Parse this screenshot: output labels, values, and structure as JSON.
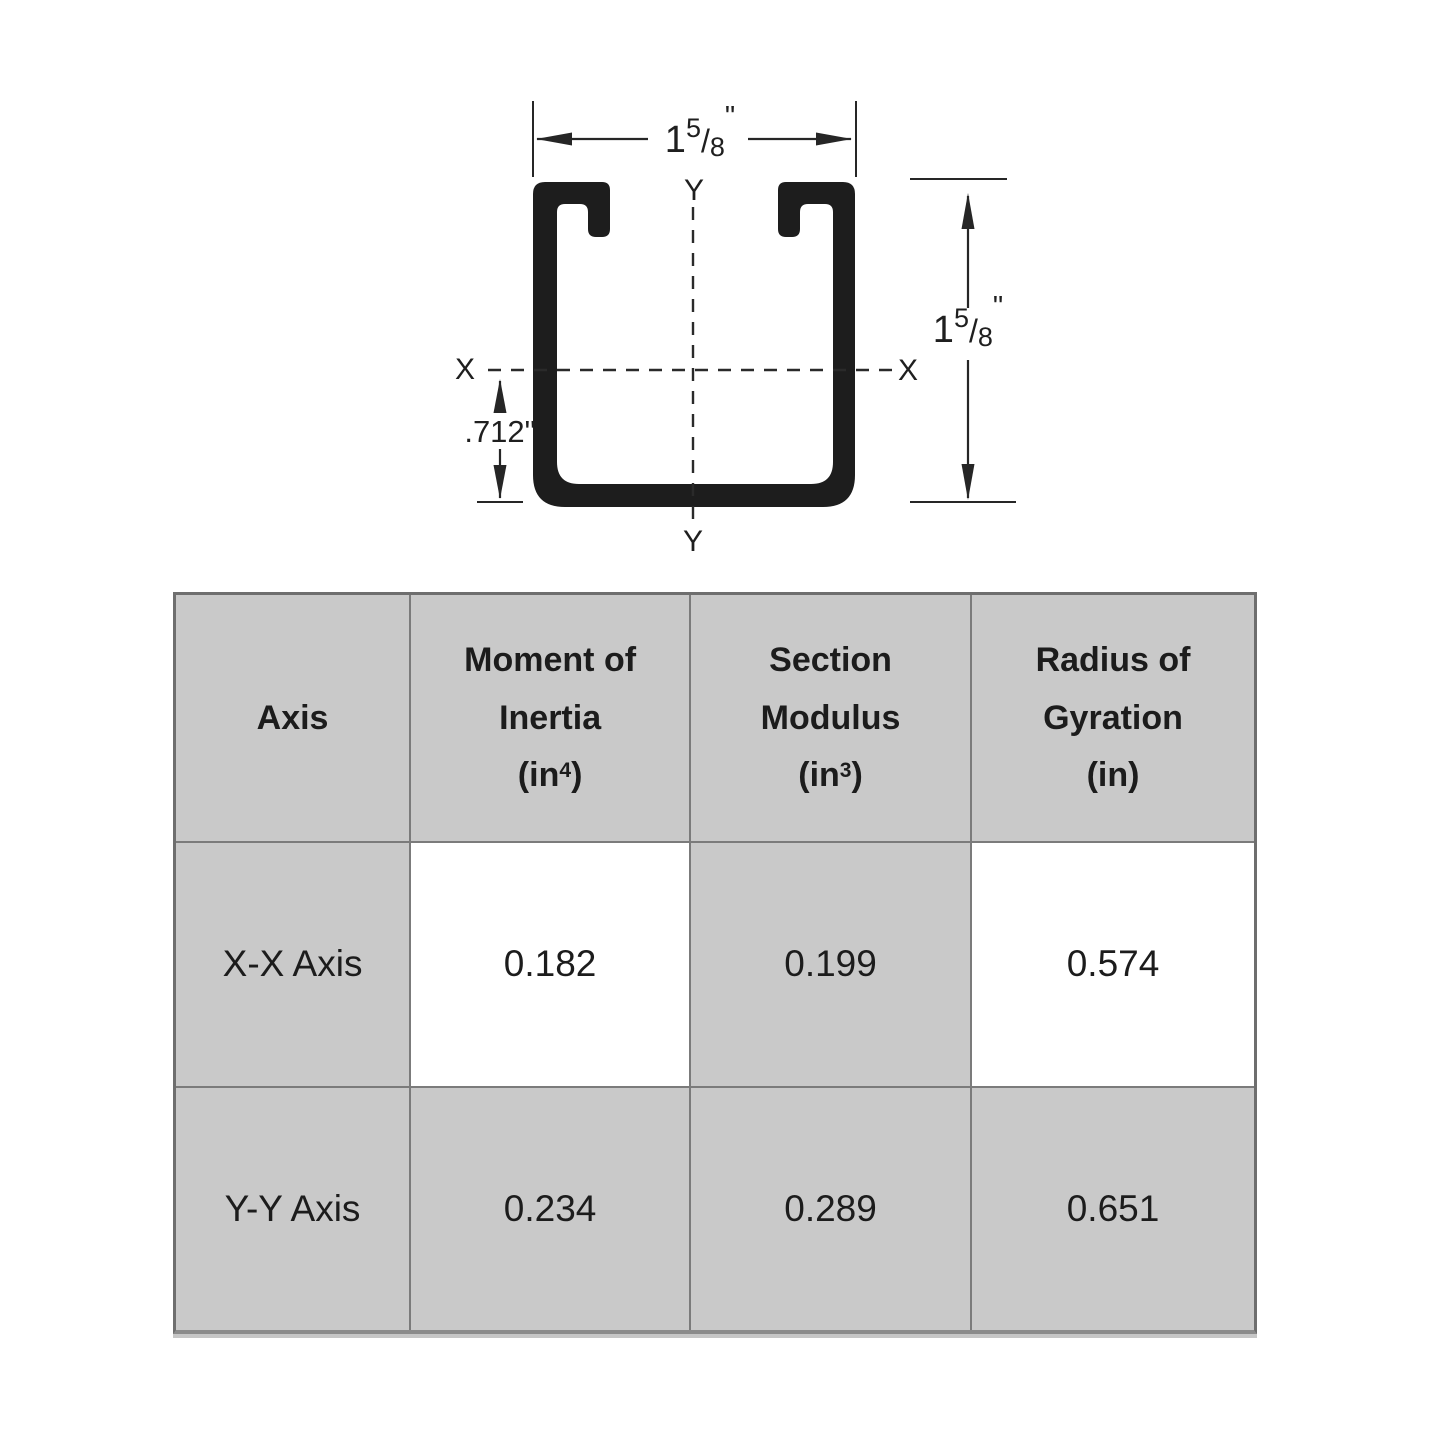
{
  "figure": {
    "width_dim": {
      "whole": "1",
      "numerator": "5",
      "slash": "/",
      "denominator": "8",
      "unit": "\""
    },
    "height_dim": {
      "whole": "1",
      "numerator": "5",
      "slash": "/",
      "denominator": "8",
      "unit": "\""
    },
    "centroid_dim": ".712\"",
    "x_label_left": "X",
    "x_label_right": "X",
    "y_label_top": "Y",
    "y_label_bottom": "Y"
  },
  "table": {
    "headers": [
      {
        "lines": [
          "Axis"
        ]
      },
      {
        "lines": [
          "Moment of",
          "Inertia"
        ],
        "unit_base": "(in",
        "unit_sup": "4",
        "unit_close": ")"
      },
      {
        "lines": [
          "Section",
          "Modulus"
        ],
        "unit_base": "(in",
        "unit_sup": "3",
        "unit_close": ")"
      },
      {
        "lines": [
          "Radius of",
          "Gyration"
        ],
        "unit_base": "(in",
        "unit_sup": "",
        "unit_close": ")"
      }
    ],
    "rows": [
      {
        "axis": "X-X Axis",
        "moment_of_inertia": "0.182",
        "section_modulus": "0.199",
        "radius_of_gyration": "0.574"
      },
      {
        "axis": "Y-Y Axis",
        "moment_of_inertia": "0.234",
        "section_modulus": "0.289",
        "radius_of_gyration": "0.651"
      }
    ]
  },
  "colors": {
    "channel_black": "#1d1d1d",
    "cell_gray": "#c9c9c9",
    "cell_border": "#7b7b7b",
    "line": "#262626"
  }
}
